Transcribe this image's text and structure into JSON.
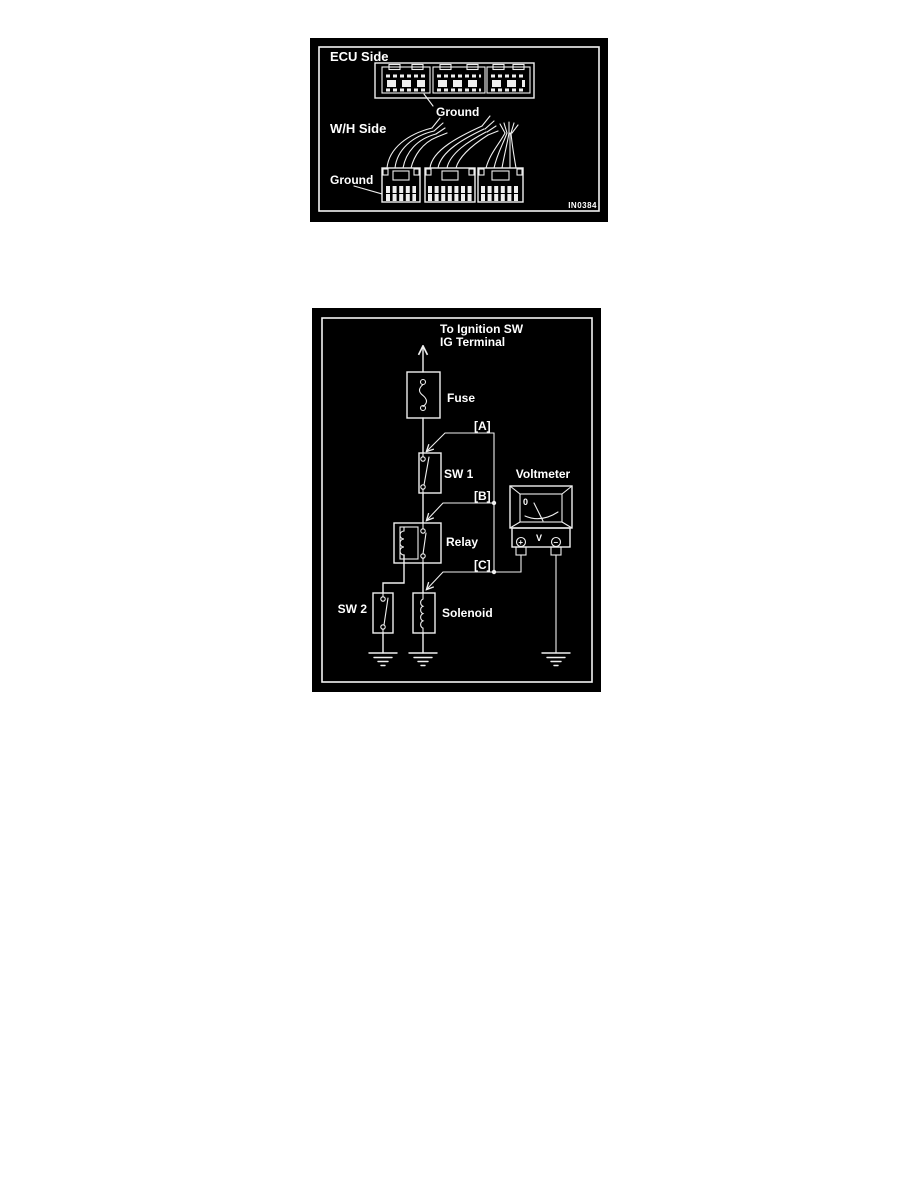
{
  "page": {
    "background": "#ffffff"
  },
  "diagram1": {
    "ecu_side_label": "ECU Side",
    "wh_side_label": "W/H Side",
    "ground_label_top": "Ground",
    "ground_label_bottom": "Ground",
    "figure_code": "IN0384",
    "colors": {
      "background": "#000000",
      "line": "#ffffff"
    }
  },
  "diagram2": {
    "header_line1": "To Ignition SW",
    "header_line2": "IG Terminal",
    "fuse_label": "Fuse",
    "sw1_label": "SW 1",
    "relay_label": "Relay",
    "sw2_label": "SW 2",
    "solenoid_label": "Solenoid",
    "voltmeter_label": "Voltmeter",
    "point_a_label": "[A]",
    "point_b_label": "[B]",
    "point_c_label": "[C]",
    "meter_zero": "0",
    "meter_unit": "V",
    "plus_terminal": "+",
    "minus_terminal": "−",
    "colors": {
      "background": "#000000",
      "line": "#ffffff"
    }
  }
}
